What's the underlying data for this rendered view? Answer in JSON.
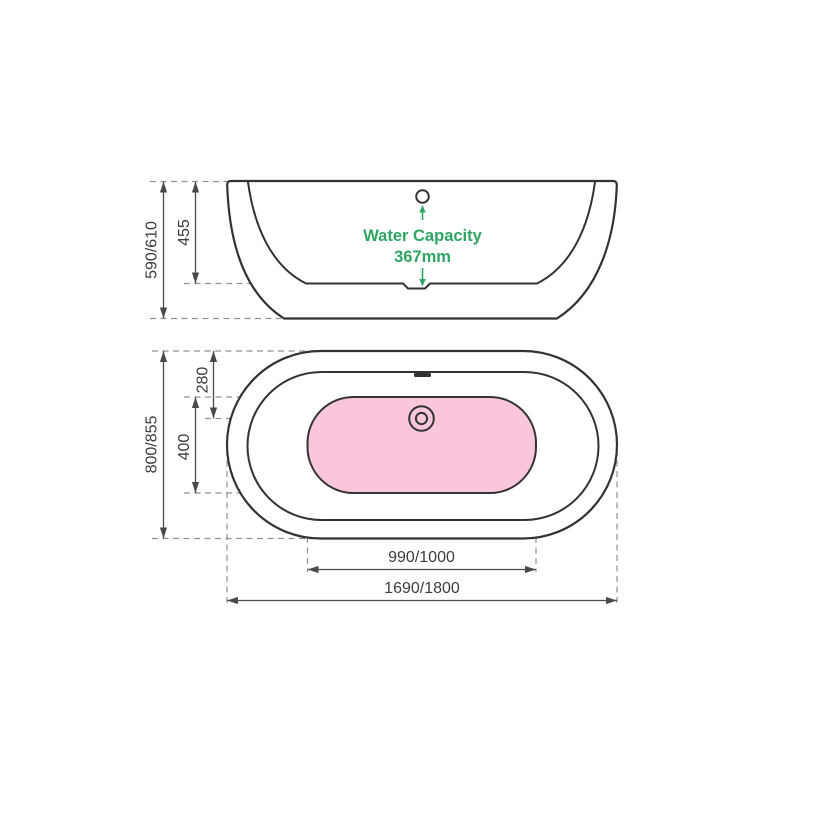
{
  "drawing": {
    "subject": "freestanding-bathtub-dimension-drawing",
    "colors": {
      "outline": "#333333",
      "dimension": "#4a4a4a",
      "dashed": "#919191",
      "accent_green": "#2ea563",
      "basin_fill": "#f9c6db",
      "text": "#3c3c3c",
      "background": "#ffffff"
    },
    "side_view": {
      "overall_height": "590/610",
      "basin_depth": "455",
      "water_capacity_label": "Water Capacity",
      "water_capacity_value": "367mm"
    },
    "plan_view": {
      "overall_depth": "800/855",
      "floor_depth": "400",
      "drain_offset": "280",
      "floor_length": "990/1000",
      "overall_length": "1690/1800"
    }
  }
}
